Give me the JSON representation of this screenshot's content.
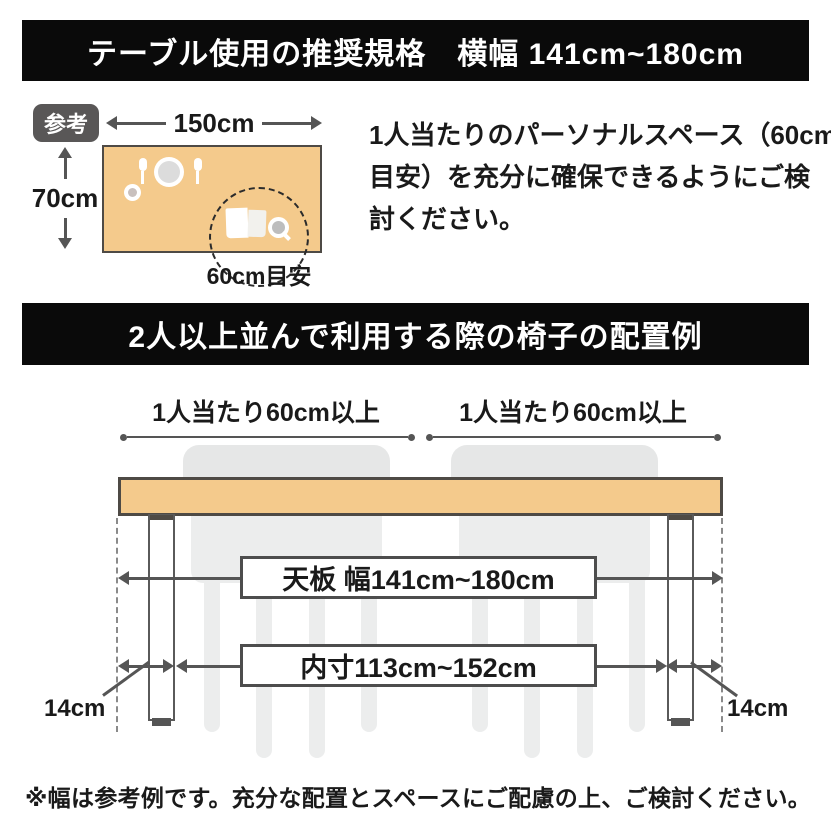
{
  "banner1": {
    "text": "テーブル使用の推奨規格　横幅 141cm~180cm"
  },
  "reference": {
    "badge": "参考",
    "width_label": "150cm",
    "depth_label": "70cm",
    "circle_label": "60cm目安",
    "note_lines": [
      "1人当たりのパーソナルスペース（60cm",
      "目安）を充分に確保できるようにご検",
      "討ください。"
    ]
  },
  "banner2": {
    "text": "2人以上並んで利用する際の椅子の配置例"
  },
  "arrangement": {
    "per_person_left": "1人当たり60cm以上",
    "per_person_right": "1人当たり60cm以上",
    "top_board": "天板 幅141cm~180cm",
    "inner_width": "内寸113cm~152cm",
    "leg_offset_left": "14cm",
    "leg_offset_right": "14cm"
  },
  "footer": {
    "note": "※幅は参考例です。充分な配置とスペースにご配慮の上、ご検討ください。"
  },
  "colors": {
    "banner_bg": "#0a0a0a",
    "banner_text": "#ffffff",
    "table_fill": "#F4CA8C",
    "table_border": "#4E4A45",
    "dim": "#555555",
    "badge_bg": "#595757",
    "text": "#1a1a1a",
    "chair": "#E6E7E7",
    "chair_light": "#ECEDED",
    "box_border": "#4d4d4d",
    "plate_inner": "#DCDCDC"
  }
}
